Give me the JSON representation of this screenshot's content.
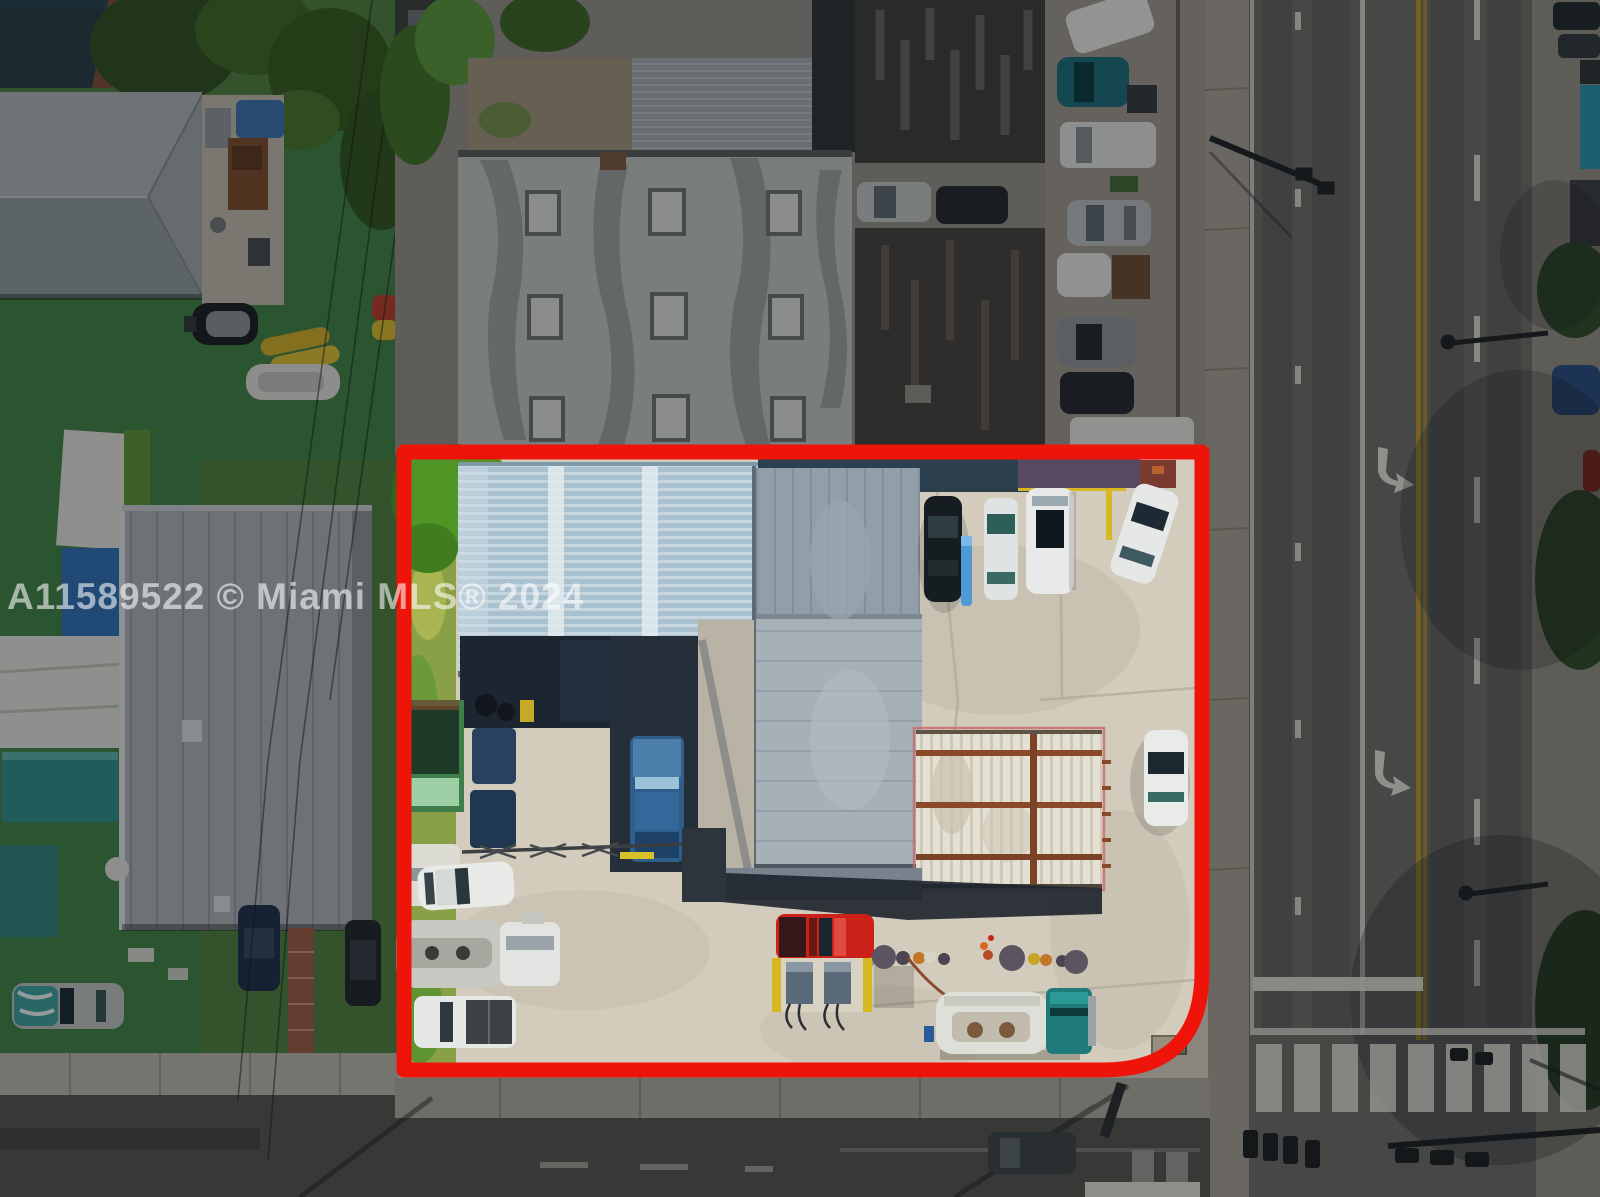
{
  "watermark": {
    "text": "A11589522 © Miami MLS® 2024"
  },
  "scene": {
    "type": "aerial-drone-photo",
    "subject": "commercial gas-station / truck-yard parcel outlined in red",
    "objects": [
      "red-property-boundary",
      "corrugated-blue-roof",
      "grey-flat-roof",
      "open-canopy-framework",
      "fuel-pump-island",
      "red-pickup-truck",
      "teal-tanker-truck",
      "silver-tanker-truck",
      "blue-semi-cab",
      "green-dumpster",
      "parked-cars-row",
      "multilane-road",
      "turn-arrow",
      "crosswalk",
      "traffic-signals",
      "residential-yard-with-boats",
      "hip-roof-house",
      "mls-watermark"
    ]
  },
  "colors": {
    "boundary_red": "#ee1409",
    "concrete": "#d3ccbd",
    "roof_corrugated_blue": "#a9c0ce",
    "roof_grey": "#929ea8",
    "roof_grey_light": "#a7b0b7",
    "grass_green": "#4d7a3c",
    "turf_green": "#3f7d46",
    "road_asphalt": "#6b6a67",
    "road_dark": "#54534f",
    "yellow_line": "#b39428",
    "watermark_white": "rgba(255,255,255,0.58)",
    "dim_overlay": "rgba(8,10,14,0.36)"
  }
}
